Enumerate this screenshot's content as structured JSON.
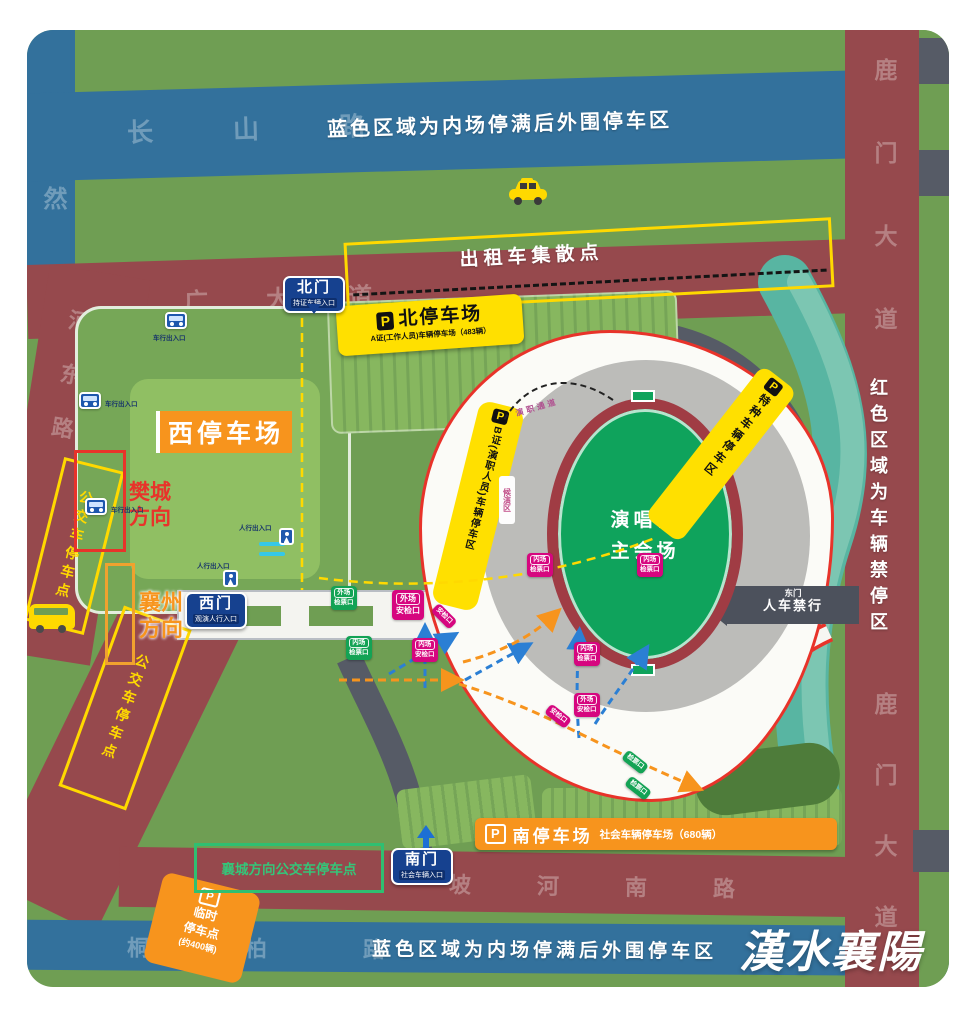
{
  "banners": {
    "blue_top": "蓝色区域为内场停满后外围停车区",
    "blue_bottom": "蓝色区域为内场停满后外围停车区",
    "red_right": "红色区域为车辆禁停区"
  },
  "roads": {
    "changshan": "长山路",
    "haoran": "浩然",
    "hanguang": "汉广大道",
    "hedong": "河东路",
    "lumen_upper": "鹿门大道",
    "lumen_lower": "鹿门大道",
    "pohenan": "坡河南路",
    "tongbai": "桐柏路"
  },
  "gates": {
    "north": {
      "name": "北门",
      "sub": "持证车辆入口"
    },
    "west": {
      "name": "西门",
      "sub": "观演人行入口"
    },
    "south": {
      "name": "南门",
      "sub": "社会车辆入口"
    },
    "east": {
      "name": "东门",
      "sub": "人车禁行"
    }
  },
  "parking": {
    "p": "P",
    "north_title": "北停车场",
    "north_sub": "A证(工作人员)车辆停车场（483辆）",
    "west_title": "西停车场",
    "south_title": "南停车场",
    "south_sub": "社会车辆停车场（680辆）",
    "temp_l1": "临时",
    "temp_l2": "停车点",
    "temp_l3": "(约400辆)",
    "b_zone": "B证(演职人员)车辆停车区",
    "special_zone": "特种车辆停车区"
  },
  "taxi_label": "出租车集散点",
  "venue": {
    "l1": "演唱会",
    "l2": "主会场",
    "waiting": "候演区",
    "corridor": "演职通道"
  },
  "directions": {
    "fancheng_l1": "樊城",
    "fancheng_l2": "方向",
    "xiangzhou_l1": "襄州",
    "xiangzhou_l2": "方向",
    "xiangcheng_bus": "襄城方向公交车停车点",
    "bus_stop1": "公交车停车点",
    "bus_stop2": "公交车停车点"
  },
  "entrances": {
    "vehicle": "车行出入口",
    "pedestrian": "人行出入口"
  },
  "checkpoints": [
    {
      "l1": "外场",
      "l2": "检票口"
    },
    {
      "l1": "外场",
      "l2": "安检口"
    },
    {
      "l1": "内场",
      "l2": "检票口"
    },
    {
      "l1": "内场",
      "l2": "安检口"
    },
    {
      "l1": "内场",
      "l2": "检票口"
    },
    {
      "l1": "内场",
      "l2": "检票口"
    },
    {
      "l1": "内场",
      "l2": "检票口"
    },
    {
      "l1": "外场",
      "l2": "安检口"
    },
    {
      "l2": "检票口"
    },
    {
      "l2": "检票口"
    },
    {
      "l2": "安检口"
    },
    {
      "l2": "安检口"
    }
  ],
  "watermark": "漢水襄陽",
  "colors": {
    "map_green": "#6f9e53",
    "blue_road": "#33719c",
    "red_road": "#96494d",
    "gray_road": "#565b66",
    "yellow": "#ffe000",
    "orange": "#f7941d",
    "badge_blue": "#16418f",
    "magenta": "#d6067f",
    "check_green": "#13a355",
    "river_teal": "#58b5a2",
    "field_green": "#0fa35c",
    "track_red": "#a03c44",
    "route_red": "#e8332a"
  }
}
